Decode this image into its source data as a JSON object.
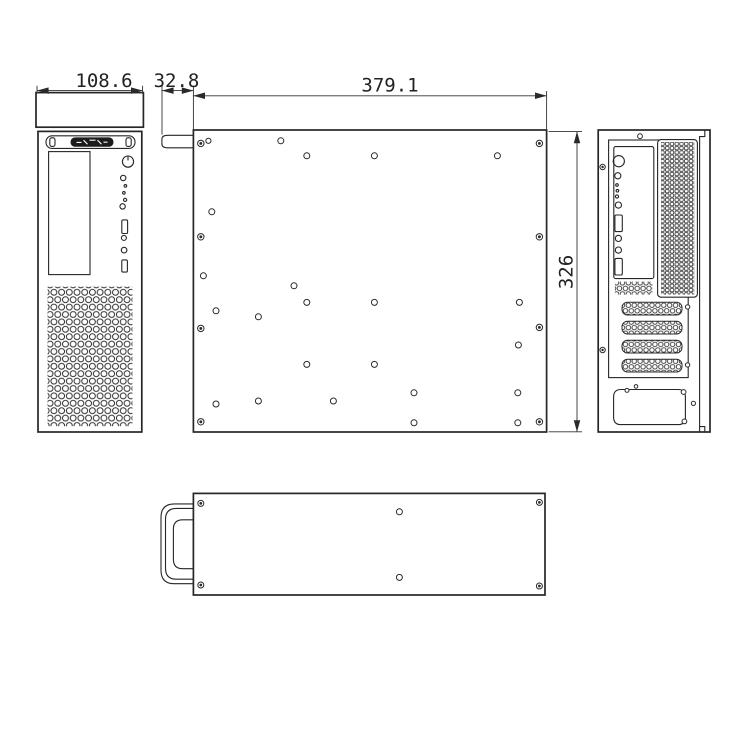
{
  "dimensions": {
    "front_width": "108.6",
    "handle_depth": "32.8",
    "chassis_length": "379.1",
    "chassis_height": "326"
  },
  "rear": {
    "expansion_slot_count": 4,
    "slot_bar_y": [
      302.2,
      321.2,
      340.2,
      359.2
    ]
  },
  "holes": {
    "side_plain": [
      [
        208.4,
        140.8,
        2.6
      ],
      [
        280.8,
        140.8,
        3
      ],
      [
        306.8,
        155.8,
        3
      ],
      [
        374.4,
        155.8,
        3
      ],
      [
        497.4,
        155.8,
        3
      ],
      [
        211.8,
        211.8,
        3
      ],
      [
        203.4,
        275.8,
        3
      ],
      [
        294,
        285.8,
        3
      ],
      [
        306.8,
        302.4,
        3
      ],
      [
        374.4,
        302.4,
        3
      ],
      [
        519.4,
        302.4,
        3
      ],
      [
        216,
        310.8,
        3
      ],
      [
        258.4,
        316.8,
        3
      ],
      [
        518.4,
        345,
        3
      ],
      [
        306.8,
        364.4,
        3
      ],
      [
        374.4,
        364.4,
        3
      ],
      [
        414,
        392.8,
        3
      ],
      [
        517.8,
        392.8,
        3
      ],
      [
        216,
        404,
        3
      ],
      [
        258.4,
        401,
        3
      ],
      [
        333.4,
        401,
        3
      ],
      [
        414,
        422.8,
        3
      ],
      [
        517.8,
        422.8,
        3
      ]
    ],
    "side_screw": [
      [
        200.8,
        143.4,
        3.2
      ],
      [
        539.4,
        143.4,
        3.2
      ],
      [
        200.8,
        236.8,
        3.2
      ],
      [
        539.4,
        236.8,
        3.2
      ],
      [
        200.8,
        328.4,
        3.2
      ],
      [
        539.4,
        327.4,
        3.2
      ],
      [
        200.8,
        421.8,
        3.2
      ],
      [
        539.4,
        421.8,
        3.2
      ]
    ],
    "rear_plain": [
      [
        640,
        136.2,
        2.4
      ],
      [
        687.6,
        306.9,
        2.2
      ],
      [
        687.6,
        364.9,
        2.2
      ],
      [
        627,
        390.4,
        2
      ],
      [
        636,
        386.4,
        1.8
      ],
      [
        683.6,
        392,
        2.4
      ],
      [
        684.4,
        421.4,
        2.4
      ],
      [
        693.4,
        403.4,
        2.1
      ]
    ],
    "rear_screw": [
      [
        602.6,
        167,
        2.7
      ],
      [
        602.6,
        350,
        2.7
      ]
    ],
    "top_plain": [
      [
        399.4,
        511.8,
        3
      ],
      [
        399.4,
        577.4,
        3
      ]
    ],
    "top_screw": [
      [
        200.8,
        503.4,
        3
      ],
      [
        200.8,
        585,
        3
      ],
      [
        539.4,
        502.4,
        3
      ],
      [
        539.4,
        586,
        3
      ]
    ]
  },
  "ink_color": "#2a2a2a",
  "background_color": "#ffffff"
}
